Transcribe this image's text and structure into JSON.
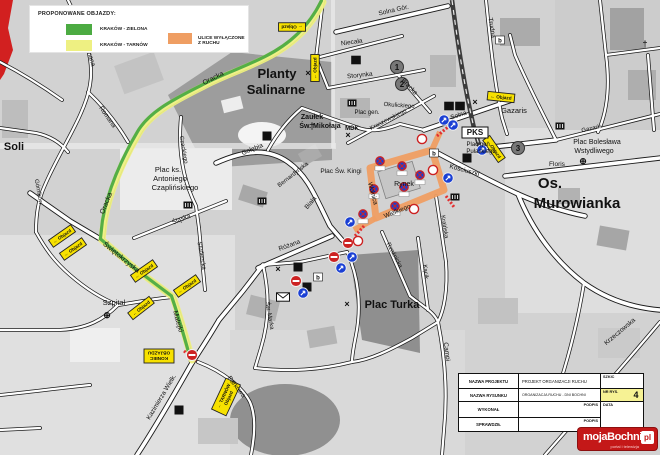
{
  "colors": {
    "detour_green": "#4cab42",
    "detour_yellow": "#eef082",
    "closed_orange": "#ef9e63",
    "sign_yellow": "#f7e100",
    "sign_blue": "#1a3fd4",
    "sign_red": "#cc2222",
    "logo_red": "#c41818"
  },
  "legend": {
    "title": "PROPONOWANE OBJAZDY:",
    "items": [
      {
        "label": "KRAKÓW - ZIELONA",
        "color": "#4cab42"
      },
      {
        "label": "KRAKÓW - TARNÓW",
        "color": "#eef082"
      },
      {
        "label": "ULICE WYŁĄCZONE Z RUCHU",
        "color": "#ef9e63"
      }
    ]
  },
  "title_block": {
    "nazwa_projektu_label": "NAZWA PROJEKTU",
    "nazwa_projektu_value": "PROJEKT ORGANIZACJI RUCHU",
    "szkic_label": "SZKIC",
    "nazwa_rysunku_label": "NAZWA RYSUNKU",
    "nazwa_rysunku_value": "ORGANIZACJA RUCHU - DNI BOCHNI",
    "nr_rys_label": "NR RYS.",
    "nr_rys_value": "4",
    "wykonal_label": "WYKONAŁ",
    "podpis_label": "PODPIS",
    "data_label": "DATA",
    "sprawdzil_label": "SPRAWDZIŁ",
    "podpis2_label": "PODPIS"
  },
  "logo": {
    "word": "mojaBochnia",
    "suffix": "pl",
    "tagline": "portal i telewizja"
  },
  "map": {
    "labels": [
      {
        "t": "Planty",
        "x": 277,
        "y": 78,
        "s": 13,
        "b": 1
      },
      {
        "t": "Salinarne",
        "x": 276,
        "y": 94,
        "s": 13,
        "b": 1
      },
      {
        "t": "Zaułek",
        "x": 312,
        "y": 119,
        "s": 7,
        "b": 1
      },
      {
        "t": "Św. Mikołaja",
        "x": 320,
        "y": 128,
        "s": 7,
        "b": 1
      },
      {
        "t": "Plac ks.",
        "x": 168,
        "y": 172,
        "s": 7.5
      },
      {
        "t": "Antoniego",
        "x": 170,
        "y": 181,
        "s": 7.5
      },
      {
        "t": "Czaplińskiego",
        "x": 175,
        "y": 190,
        "s": 7.5
      },
      {
        "t": "Soli",
        "x": 14,
        "y": 150,
        "s": 11,
        "b": 1
      },
      {
        "t": "Szpital",
        "x": 114,
        "y": 305,
        "s": 7.5
      },
      {
        "t": "Plac Turka",
        "x": 392,
        "y": 308,
        "s": 11,
        "b": 1
      },
      {
        "t": "Os.",
        "x": 550,
        "y": 188,
        "s": 15,
        "b": 1
      },
      {
        "t": "Murowianka",
        "x": 577,
        "y": 208,
        "s": 15,
        "b": 1
      },
      {
        "t": "Rynek",
        "x": 404,
        "y": 186,
        "s": 7
      },
      {
        "t": "Plac Św. Kingi",
        "x": 341,
        "y": 173,
        "s": 6.5
      },
      {
        "t": "MDK",
        "x": 352,
        "y": 130,
        "s": 6,
        "b": 1
      },
      {
        "t": "Plac gen.",
        "x": 367,
        "y": 114,
        "s": 6
      },
      {
        "t": "Okulickiego",
        "x": 399,
        "y": 107,
        "s": 6,
        "r": 4
      },
      {
        "t": "Plac gen.",
        "x": 479,
        "y": 146,
        "s": 6
      },
      {
        "t": "Pułaskiego",
        "x": 481,
        "y": 153,
        "s": 6
      },
      {
        "t": "Plac Bolesława",
        "x": 597,
        "y": 144,
        "s": 7
      },
      {
        "t": "Wstydliwego",
        "x": 594,
        "y": 153,
        "s": 7
      },
      {
        "t": "Gazaris",
        "x": 514,
        "y": 113,
        "s": 7.5
      },
      {
        "t": "Gazaris",
        "x": 592,
        "y": 130,
        "s": 6,
        "r": -13
      },
      {
        "t": "Floris",
        "x": 557,
        "y": 166,
        "s": 6.5
      },
      {
        "t": "Oracka",
        "x": 214,
        "y": 80,
        "s": 7,
        "r": -27
      },
      {
        "t": "Oracka",
        "x": 108,
        "y": 204,
        "s": 7,
        "r": -68
      },
      {
        "t": "Świętokrzyska",
        "x": 120,
        "y": 259,
        "s": 7,
        "r": 39
      },
      {
        "t": "Matejki",
        "x": 176,
        "y": 322,
        "s": 7,
        "r": 74
      },
      {
        "t": "Kazimierza Wielk.",
        "x": 163,
        "y": 398,
        "s": 6.5,
        "r": -59
      },
      {
        "t": "Parkowa",
        "x": 235,
        "y": 388,
        "s": 6.5,
        "r": 52
      },
      {
        "t": "Solna Gór.",
        "x": 394,
        "y": 12,
        "s": 6.5,
        "r": -13
      },
      {
        "t": "Niecała",
        "x": 352,
        "y": 44,
        "s": 6.5,
        "r": -8
      },
      {
        "t": "Storynka",
        "x": 360,
        "y": 77,
        "s": 6.5,
        "r": -6
      },
      {
        "t": "Bracka",
        "x": 408,
        "y": 88,
        "s": 6.5,
        "r": 46
      },
      {
        "t": "Trudna",
        "x": 490,
        "y": 28,
        "s": 6.5,
        "r": 81
      },
      {
        "t": "Kraszewskiego",
        "x": 389,
        "y": 121,
        "s": 6,
        "r": -27
      },
      {
        "t": "Solna",
        "x": 459,
        "y": 117,
        "s": 6.5,
        "r": -18
      },
      {
        "t": "Kościuszki",
        "x": 464,
        "y": 172,
        "s": 6.5,
        "r": 15
      },
      {
        "t": "Kraińska",
        "x": 443,
        "y": 227,
        "s": 6,
        "r": 81
      },
      {
        "t": "Kącik",
        "x": 424,
        "y": 272,
        "s": 6,
        "r": 83
      },
      {
        "t": "Rzeźnicka",
        "x": 393,
        "y": 256,
        "s": 6,
        "r": 62
      },
      {
        "t": "Różana",
        "x": 290,
        "y": 247,
        "s": 6.5,
        "r": -20
      },
      {
        "t": "Św. Marka",
        "x": 268,
        "y": 316,
        "s": 6,
        "r": 80
      },
      {
        "t": "Gołębia",
        "x": 253,
        "y": 151,
        "s": 6.5,
        "r": -22
      },
      {
        "t": "Bernardyńska",
        "x": 294,
        "y": 176,
        "s": 6,
        "r": -38
      },
      {
        "t": "Biała",
        "x": 312,
        "y": 204,
        "s": 6.5,
        "r": -50
      },
      {
        "t": "Śląska",
        "x": 182,
        "y": 221,
        "s": 6.5,
        "r": -22
      },
      {
        "t": "Studencka",
        "x": 200,
        "y": 256,
        "s": 6,
        "r": 80
      },
      {
        "t": "Czackiego",
        "x": 182,
        "y": 150,
        "s": 6,
        "r": 80
      },
      {
        "t": "Romana",
        "x": 88,
        "y": 55,
        "s": 6.5,
        "r": 72
      },
      {
        "t": "Romana",
        "x": 106,
        "y": 118,
        "s": 6.5,
        "r": 55
      },
      {
        "t": "Górników",
        "x": 37,
        "y": 192,
        "s": 6,
        "r": 80
      },
      {
        "t": "Campi",
        "x": 445,
        "y": 352,
        "s": 6.5,
        "r": 82
      },
      {
        "t": "Krzeczowska",
        "x": 621,
        "y": 333,
        "s": 6.5,
        "r": -40
      },
      {
        "t": "Wolnica",
        "x": 371,
        "y": 194,
        "s": 6.5,
        "r": 75
      },
      {
        "t": "Wielkiego",
        "x": 398,
        "y": 213,
        "s": 6.5,
        "r": -22
      },
      {
        "t": "PKS",
        "x": 475,
        "y": 135,
        "s": 8,
        "b": 1,
        "box": 1
      }
    ],
    "objazd_signs": [
      {
        "x": 292,
        "y": 27,
        "r": 180,
        "lines": [
          "← Objazd"
        ]
      },
      {
        "x": 315,
        "y": 68,
        "r": -90,
        "lines": [
          "← Objazd"
        ]
      },
      {
        "x": 62,
        "y": 236,
        "r": -35,
        "lines": [
          "← Objazd"
        ]
      },
      {
        "x": 73,
        "y": 249,
        "r": -35,
        "lines": [
          "← Objazd"
        ]
      },
      {
        "x": 144,
        "y": 271,
        "r": -35,
        "lines": [
          "← Objazd"
        ]
      },
      {
        "x": 187,
        "y": 286,
        "r": -35,
        "lines": [
          "← Objazd"
        ]
      },
      {
        "x": 141,
        "y": 308,
        "r": -38,
        "lines": [
          "← Objazd"
        ]
      },
      {
        "x": 501,
        "y": 97,
        "r": 6,
        "lines": [
          "← Objazd"
        ]
      },
      {
        "x": 494,
        "y": 149,
        "r": 55,
        "lines": [
          "← Objazd"
        ]
      },
      {
        "x": 159,
        "y": 356,
        "r": 180,
        "w": 30,
        "h": 14,
        "lines": [
          "KONIEC",
          "OBJAZDU"
        ]
      },
      {
        "x": 226,
        "y": 397,
        "r": -65,
        "w": 34,
        "h": 16,
        "lines": [
          "← TARNÓW",
          "Objazd"
        ]
      }
    ],
    "no_entry_signs": [
      {
        "x": 192,
        "y": 355
      },
      {
        "x": 348,
        "y": 243
      },
      {
        "x": 334,
        "y": 257
      },
      {
        "x": 296,
        "y": 281
      }
    ],
    "blue_signs": [
      {
        "x": 444,
        "y": 120
      },
      {
        "x": 453,
        "y": 125
      },
      {
        "x": 448,
        "y": 178
      },
      {
        "x": 482,
        "y": 150
      },
      {
        "x": 341,
        "y": 268
      },
      {
        "x": 352,
        "y": 257
      },
      {
        "x": 303,
        "y": 293
      },
      {
        "x": 350,
        "y": 222
      }
    ],
    "no_stopping_signs": [
      {
        "x": 380,
        "y": 161
      },
      {
        "x": 402,
        "y": 166
      },
      {
        "x": 374,
        "y": 189
      },
      {
        "x": 404,
        "y": 187
      },
      {
        "x": 420,
        "y": 175
      },
      {
        "x": 395,
        "y": 206
      },
      {
        "x": 363,
        "y": 214
      }
    ],
    "white_circle_signs": [
      {
        "x": 422,
        "y": 139
      },
      {
        "x": 433,
        "y": 170
      },
      {
        "x": 414,
        "y": 209
      },
      {
        "x": 358,
        "y": 241
      }
    ],
    "black_number_boxes": [
      {
        "x": 267,
        "y": 136,
        "n": "3"
      },
      {
        "x": 298,
        "y": 267,
        "n": "2"
      },
      {
        "x": 467,
        "y": 158,
        "n": "5"
      },
      {
        "x": 307,
        "y": 287,
        "n": "7"
      },
      {
        "x": 179,
        "y": 410,
        "n": "4"
      }
    ],
    "circle_numbers": [
      {
        "x": 397,
        "y": 67,
        "n": "1"
      },
      {
        "x": 402,
        "y": 84,
        "n": "2"
      },
      {
        "x": 518,
        "y": 148,
        "n": "3"
      }
    ],
    "box_letters": [
      {
        "x": 356,
        "y": 60,
        "t": "H",
        "bg": "#111",
        "fg": "#fff"
      },
      {
        "x": 449,
        "y": 106,
        "t": "it",
        "bg": "#111",
        "fg": "#fff"
      },
      {
        "x": 460,
        "y": 106,
        "t": "H",
        "bg": "#111",
        "fg": "#fff"
      },
      {
        "x": 500,
        "y": 40,
        "t": "b",
        "bg": "#fff",
        "fg": "#111"
      },
      {
        "x": 434,
        "y": 153,
        "t": "b",
        "bg": "#fff",
        "fg": "#111"
      },
      {
        "x": 318,
        "y": 277,
        "t": "b",
        "bg": "#fff",
        "fg": "#111"
      }
    ],
    "museum_icons": [
      {
        "x": 188,
        "y": 205
      },
      {
        "x": 262,
        "y": 201
      },
      {
        "x": 352,
        "y": 103
      },
      {
        "x": 560,
        "y": 126
      },
      {
        "x": 455,
        "y": 197
      }
    ],
    "glyph_icons": [
      {
        "g": "†",
        "x": 312,
        "y": 129,
        "name": "church-icon"
      },
      {
        "g": "†",
        "x": 645,
        "y": 47,
        "name": "church-icon"
      },
      {
        "g": "×",
        "x": 347,
        "y": 307,
        "name": "poi-icon"
      },
      {
        "g": "×",
        "x": 308,
        "y": 76,
        "name": "poi-icon"
      },
      {
        "g": "×",
        "x": 348,
        "y": 138,
        "name": "poi-icon"
      },
      {
        "g": "×",
        "x": 475,
        "y": 105,
        "name": "poi-icon"
      },
      {
        "g": "×",
        "x": 278,
        "y": 272,
        "name": "poi-icon"
      },
      {
        "g": "⊕",
        "x": 107,
        "y": 318,
        "name": "hospital-icon"
      },
      {
        "g": "⊕",
        "x": 583,
        "y": 164,
        "name": "health-icon"
      }
    ]
  }
}
